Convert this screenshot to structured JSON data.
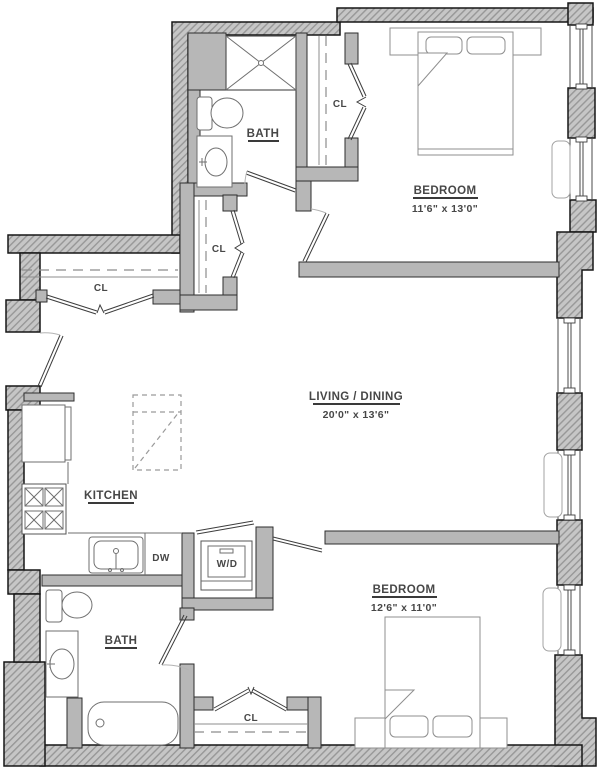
{
  "rooms": {
    "bath_top": {
      "label": "BATH"
    },
    "bedroom_top": {
      "label": "BEDROOM",
      "dims": "11'6\" x 13'0\""
    },
    "living_dining": {
      "label": "LIVING / DINING",
      "dims": "20'0\" x 13'6\""
    },
    "kitchen": {
      "label": "KITCHEN"
    },
    "bath_bottom": {
      "label": "BATH"
    },
    "bedroom_bottom": {
      "label": "BEDROOM",
      "dims": "12'6\" x 11'0\""
    }
  },
  "closets": {
    "bedroom_top_closet": "CL",
    "entry_closet": "CL",
    "hall_closet": "CL",
    "bedroom_bottom_closet": "CL"
  },
  "appliances": {
    "dishwasher": "DW",
    "washer_dryer": "W/D"
  },
  "colors": {
    "wall_fill": "#c6c6c6",
    "wall_hatch": "#979797",
    "outline": "#161616",
    "interior_wall": "#b7b7b7",
    "fixture_line": "#6f6f6f",
    "text": "#474747"
  }
}
